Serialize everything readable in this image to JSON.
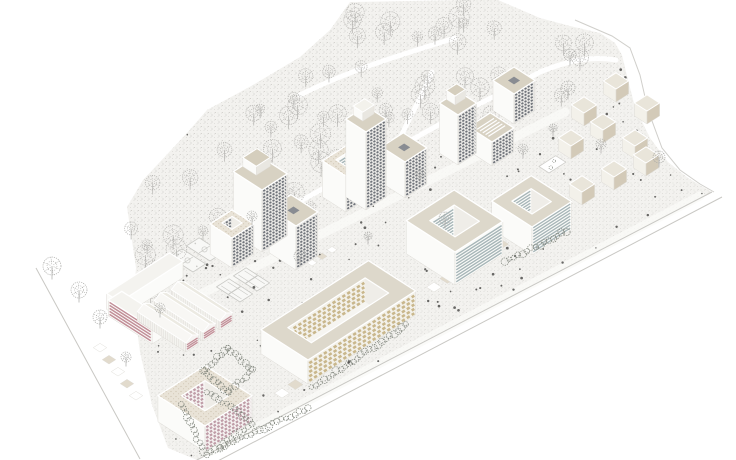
{
  "scene": {
    "canvas": {
      "w": 736,
      "h": 460
    },
    "colors": {
      "ground": "#f3f2ef",
      "stipple1": "#dbdad6",
      "stipple2": "#cccbc7",
      "line": "#d0cfcb",
      "road": "#c9c8c4",
      "street": "#fafaf8",
      "treeStroke": "#b5b4b1",
      "hedgeStroke": "#83887f",
      "dot": "#4d4d4b",
      "roofBeige": "#d8d2c3",
      "roofLight": "#eeebe3",
      "roofWhite": "#f4f3ef",
      "roofRing": "#ddd8cb",
      "roofSpeckleBase": "#e9e3d7",
      "speckleDot": "#cfc5b3",
      "capWhite": "#f3f2ec",
      "capBeige": "#d5cebd",
      "capShade": "#e9e7e1",
      "skylight": "#898c92",
      "wallWhite": "#fbfbf9",
      "wallEdge": "#dedcd7",
      "gridBg": "#e8e7e4",
      "winDark": "#6f737a",
      "stripeBlue": "#a7b6b8",
      "gridKhaki": "#c9b78c",
      "gridPink": "#bf9ca7",
      "stripePink": "#c28f98",
      "holeFloor": "#f6f5f1",
      "holeSide": "#efede8",
      "cubeTop": "#e9e5da",
      "cubeSE": "#d3cab8",
      "cubeSW": "#f3f1ea",
      "courtFill": "#f8f8f6",
      "courtLine": "#c9c9c5",
      "furnitureA": "#ffffff",
      "furnitureB": "#e2dbcd",
      "shedWall": "#f5f4f0",
      "shedEnd": "#f6f4f2",
      "shedRoofA": "#f8f7f4",
      "shedRoofB": "#eceae2"
    },
    "site_polygon": [
      [
        350,
        2
      ],
      [
        470,
        0
      ],
      [
        498,
        0
      ],
      [
        540,
        18
      ],
      [
        570,
        26
      ],
      [
        600,
        33
      ],
      [
        615,
        43
      ],
      [
        622,
        55
      ],
      [
        628,
        80
      ],
      [
        635,
        107
      ],
      [
        650,
        138
      ],
      [
        668,
        162
      ],
      [
        688,
        178
      ],
      [
        712,
        192
      ],
      [
        197,
        460
      ],
      [
        168,
        448
      ],
      [
        152,
        405
      ],
      [
        140,
        352
      ],
      [
        133,
        300
      ],
      [
        136,
        268
      ],
      [
        127,
        207
      ],
      [
        143,
        180
      ],
      [
        187,
        133
      ],
      [
        207,
        110
      ],
      [
        253,
        85
      ],
      [
        300,
        57
      ],
      [
        330,
        30
      ]
    ],
    "forest_polygon": [
      [
        350,
        4
      ],
      [
        478,
        3
      ],
      [
        543,
        22
      ],
      [
        598,
        40
      ],
      [
        620,
        60
      ],
      [
        606,
        84
      ],
      [
        566,
        100
      ],
      [
        520,
        122
      ],
      [
        468,
        143
      ],
      [
        410,
        168
      ],
      [
        350,
        196
      ],
      [
        290,
        224
      ],
      [
        228,
        252
      ],
      [
        175,
        278
      ],
      [
        145,
        295
      ],
      [
        136,
        268
      ],
      [
        128,
        210
      ],
      [
        144,
        182
      ],
      [
        188,
        134
      ],
      [
        208,
        111
      ],
      [
        254,
        86
      ],
      [
        300,
        58
      ],
      [
        331,
        30
      ]
    ],
    "forest": {
      "seed": 5,
      "count": 82,
      "min_dist": 7.5
    },
    "people": {
      "seed": 11,
      "count": 175
    },
    "white_paths": [
      "M210,258 C270,215 330,185 395,150 C440,122 480,105 540,72",
      "M395,150 C405,125 418,105 432,72",
      "M540,72 C570,60 592,56 616,60",
      "M300,95 C350,70 400,55 455,38"
    ],
    "streets": [
      "M185,302 C300,245 440,175 565,112",
      "M210,452 L700,196"
    ],
    "boundary_lines": [
      [
        [
          712,
          192
        ],
        [
          197,
          460
        ]
      ],
      [
        [
          722,
          197
        ],
        [
          212,
          464
        ]
      ],
      [
        [
          36,
          268
        ],
        [
          140,
          459
        ]
      ]
    ],
    "ne_boundary": [
      [
        575,
        20
      ],
      [
        612,
        36
      ],
      [
        630,
        48
      ],
      [
        640,
        75
      ],
      [
        648,
        110
      ],
      [
        662,
        148
      ],
      [
        680,
        170
      ],
      [
        700,
        184
      ],
      [
        714,
        192
      ]
    ],
    "buildings": [
      {
        "name": "tower-northeast",
        "S": [
          514,
          124
        ],
        "a": 25,
        "b": 25,
        "h": 30,
        "roof": "skylight",
        "se": "grid-dark"
      },
      {
        "name": "tower-roof-stripes",
        "S": [
          492,
          166
        ],
        "a": 28,
        "b": 26,
        "h": 24,
        "roof": "roofstripes",
        "se": "grid-dark"
      },
      {
        "name": "tower-tall-east",
        "S": [
          458,
          165
        ],
        "a": 22,
        "b": 22,
        "h": 50,
        "roof": "cap-beige",
        "se": "grid-dark"
      },
      {
        "name": "tower-skylight-mid",
        "S": [
          405,
          198
        ],
        "a": 28,
        "b": 26,
        "h": 36,
        "roof": "skylight",
        "se": "grid-dark"
      },
      {
        "name": "courtyard-speckled-mid",
        "S": [
          346,
          212
        ],
        "a": 28,
        "b": 28,
        "h": 36,
        "roof": "speckle",
        "se": "grid-dark",
        "hole": [
          9,
          21,
          9,
          21
        ],
        "holeStyle": "stripes-blue"
      },
      {
        "name": "tower-tall-center",
        "S": [
          366,
          210
        ],
        "a": 24,
        "b": 24,
        "h": 78,
        "roof": "cap-white",
        "se": "grid-dark"
      },
      {
        "name": "block-skylight-west",
        "S": [
          296,
          270
        ],
        "a": 32,
        "b": 26,
        "h": 44,
        "roof": "skylight",
        "se": "grid-dark"
      },
      {
        "name": "tower-west",
        "S": [
          262,
          252
        ],
        "a": 34,
        "b": 30,
        "h": 62,
        "roof": "cap-beige",
        "se": "grid-dark"
      },
      {
        "name": "courtyard-tower-west",
        "S": [
          232,
          268
        ],
        "a": 26,
        "b": 26,
        "h": 30,
        "roof": "speckle",
        "se": "grid-dark",
        "hole": [
          8,
          20,
          8,
          20
        ],
        "holeStyle": "grid-dark"
      },
      {
        "name": "courtyard-blue-east",
        "S": [
          532,
          255
        ],
        "a": 48,
        "b": 47,
        "h": 28,
        "roof": "ring",
        "se": "stripes-blue",
        "hole": [
          12,
          36,
          12,
          35
        ],
        "holeStyle": "stripes-blue"
      },
      {
        "name": "courtyard-blue-center",
        "S": [
          455,
          285
        ],
        "a": 58,
        "b": 57,
        "h": 33,
        "roof": "ring",
        "se": "stripes-blue",
        "hole": [
          14,
          44,
          14,
          43
        ],
        "holeStyle": "stripes-blue"
      },
      {
        "name": "courtyard-khaki",
        "S": [
          308,
          384
        ],
        "a": 56,
        "b": 128,
        "h": 24,
        "roof": "ring",
        "se": "grid-khaki",
        "hole": [
          14,
          42,
          18,
          110
        ],
        "holeStyle": "grid-khaki"
      },
      {
        "name": "l-building-north-wing",
        "S": [
          120,
          318
        ],
        "a": 16,
        "b": 75,
        "h": 16,
        "roof": "plain-white",
        "se": "plain"
      },
      {
        "name": "l-building-south-wing",
        "S": [
          152,
          344
        ],
        "a": 52,
        "b": 16,
        "h": 16,
        "roof": "plain-white",
        "se": "plain",
        "sw": "stripes-pink"
      },
      {
        "name": "shed-bay-3",
        "type": "shed",
        "S": [
          220,
          330
        ],
        "a": 58,
        "b": 15,
        "h": 9,
        "r": 4
      },
      {
        "name": "shed-bay-2",
        "type": "shed",
        "S": [
          203,
          341
        ],
        "a": 58,
        "b": 15,
        "h": 9,
        "r": 4
      },
      {
        "name": "shed-bay-1",
        "type": "shed",
        "S": [
          186,
          352
        ],
        "a": 58,
        "b": 15,
        "h": 9,
        "r": 4
      },
      {
        "name": "courtyard-pink",
        "S": [
          205,
          452
        ],
        "a": 56,
        "b": 56,
        "h": 26,
        "roof": "speckle",
        "se": "grid-pink",
        "hole": [
          14,
          42,
          14,
          42
        ],
        "holeStyle": "grid-pink"
      }
    ],
    "cube_houses": {
      "size_a": 15,
      "size_b": 15,
      "h": 13,
      "positions": [
        [
          616,
          102
        ],
        [
          584,
          126
        ],
        [
          647,
          124
        ],
        [
          571,
          159
        ],
        [
          603,
          143
        ],
        [
          635,
          159
        ],
        [
          582,
          205
        ],
        [
          614,
          190
        ],
        [
          646,
          176
        ]
      ]
    },
    "hedgerows": [
      [
        182,
        404,
        203,
        452
      ],
      [
        207,
        455,
        252,
        424
      ],
      [
        207,
        392,
        250,
        420
      ],
      [
        312,
        388,
        406,
        325
      ],
      [
        505,
        262,
        566,
        231
      ],
      [
        220,
        448,
        308,
        408
      ]
    ],
    "hedge_ring": [
      [
        228,
        392
      ],
      [
        204,
        370
      ],
      [
        228,
        348
      ],
      [
        252,
        370
      ]
    ],
    "courts": [
      {
        "name": "basketball-court-1",
        "S": [
          193,
          272
        ],
        "a": 28,
        "b": 15,
        "type": "basketball"
      },
      {
        "name": "basketball-court-2",
        "S": [
          210,
          261
        ],
        "a": 28,
        "b": 15,
        "type": "basketball"
      },
      {
        "name": "tennis-court-1",
        "S": [
          240,
          302
        ],
        "a": 28,
        "b": 15,
        "type": "tennis"
      },
      {
        "name": "tennis-court-2",
        "S": [
          257,
          291
        ],
        "a": 28,
        "b": 15,
        "type": "tennis"
      }
    ],
    "furniture_rows": [
      {
        "start": [
          100,
          352
        ],
        "step": [
          9,
          12
        ],
        "n": 5,
        "s": 8
      },
      {
        "start": [
          282,
          398
        ],
        "step": [
          13.4,
          -8.6
        ],
        "n": 6,
        "s": 9
      },
      {
        "start": [
          434,
          292
        ],
        "step": [
          13.4,
          -8.6
        ],
        "n": 6,
        "s": 9
      },
      {
        "start": [
          312,
          266
        ],
        "step": [
          10,
          -6.5
        ],
        "n": 3,
        "s": 6
      }
    ],
    "kiosk": {
      "S": [
        549,
        173
      ],
      "a": 12,
      "b": 20
    },
    "scatter_trees": [
      [
        52,
        266,
        9
      ],
      [
        79,
        290,
        8
      ],
      [
        100,
        317,
        7
      ],
      [
        300,
        256,
        6
      ],
      [
        252,
        216,
        5
      ],
      [
        445,
        218,
        6
      ],
      [
        420,
        174,
        5
      ],
      [
        570,
        55,
        6
      ],
      [
        568,
        88,
        7
      ],
      [
        601,
        144,
        5
      ],
      [
        659,
        157,
        6
      ],
      [
        523,
        149,
        5
      ],
      [
        553,
        128,
        4
      ],
      [
        368,
        236,
        4
      ],
      [
        160,
        308,
        5
      ],
      [
        126,
        357,
        5
      ]
    ]
  }
}
